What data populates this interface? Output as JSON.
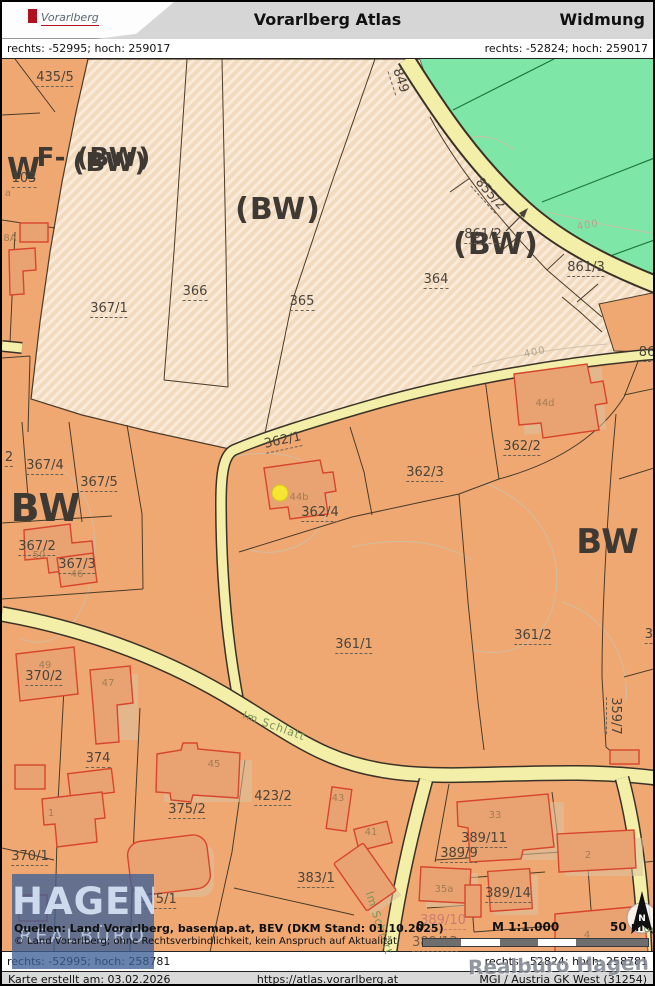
{
  "header": {
    "title": "Vorarlberg Atlas",
    "mode": "Widmung",
    "logo_text": "Vorarlberg"
  },
  "coords": {
    "top_left": "rechts: -52995; hoch: 259017",
    "top_right": "rechts: -52824; hoch: 259017",
    "bottom_left": "rechts: -52995; hoch: 258781",
    "bottom_right": "rechts: -52824; hoch: 258781"
  },
  "footer": {
    "created": "Karte erstellt am: 03.02.2026",
    "url": "https://atlas.vorarlberg.at",
    "crs": "MGI / Austria GK West (31254)"
  },
  "sources": {
    "line1": "Quellen: Land Vorarlberg, basemap.at, BEV (DKM Stand: 01.10.2025)",
    "line2": "© Land Vorarlberg; ohne Rechtsverbindlichkeit, kein Anspruch auf Aktualität"
  },
  "watermark": {
    "name": "HAGEN",
    "sub": "REALBÜRO",
    "corner": "Realbüro Hagen"
  },
  "scalebar": {
    "zero": "0",
    "scale": "M 1:1.000",
    "distance": "50 m"
  },
  "north": {
    "label": "N"
  },
  "colors": {
    "zone_bw": "#F0A873",
    "zone_planned": "#F2DABE",
    "zone_green": "#7EE6A7",
    "road": "#F3EFA8",
    "building_stroke": "#D7452C",
    "selection_dot": "#F6E632",
    "watermark_blue": "#3E6096"
  },
  "map": {
    "zone_labels": [
      {
        "t": "W",
        "x": 22,
        "y": 168,
        "s": 30
      },
      {
        "t": "F- (BW)",
        "x": 92,
        "y": 156,
        "s": 26
      },
      {
        "t": "(BW)",
        "x": 108,
        "y": 161,
        "s": 26
      },
      {
        "t": "(BW)",
        "x": 276,
        "y": 208,
        "s": 30
      },
      {
        "t": "(BW)",
        "x": 494,
        "y": 243,
        "s": 30
      },
      {
        "t": "BW",
        "x": 44,
        "y": 506,
        "s": 38
      },
      {
        "t": "BW",
        "x": 606,
        "y": 540,
        "s": 34
      }
    ],
    "parcel_labels": [
      {
        "t": "435/5",
        "x": 53,
        "y": 77
      },
      {
        "t": "103",
        "x": 22,
        "y": 178
      },
      {
        "t": "2",
        "x": 7,
        "y": 457
      },
      {
        "t": "367/1",
        "x": 107,
        "y": 308
      },
      {
        "t": "366",
        "x": 193,
        "y": 291
      },
      {
        "t": "365",
        "x": 300,
        "y": 301
      },
      {
        "t": "364",
        "x": 434,
        "y": 279
      },
      {
        "t": "849",
        "x": 397,
        "y": 79,
        "r": 72
      },
      {
        "t": "855/2",
        "x": 487,
        "y": 193,
        "r": 48
      },
      {
        "t": "861/2",
        "x": 481,
        "y": 234
      },
      {
        "t": "861/3",
        "x": 584,
        "y": 267
      },
      {
        "t": "86",
        "x": 645,
        "y": 352
      },
      {
        "t": "367/4",
        "x": 43,
        "y": 465
      },
      {
        "t": "367/5",
        "x": 97,
        "y": 482
      },
      {
        "t": "367/2",
        "x": 35,
        "y": 546
      },
      {
        "t": "367/3",
        "x": 75,
        "y": 564
      },
      {
        "t": "362/1",
        "x": 281,
        "y": 440,
        "r": -12
      },
      {
        "t": "362/2",
        "x": 520,
        "y": 446
      },
      {
        "t": "362/3",
        "x": 423,
        "y": 472
      },
      {
        "t": "362/4",
        "x": 318,
        "y": 512
      },
      {
        "t": "361/1",
        "x": 352,
        "y": 644
      },
      {
        "t": "361/2",
        "x": 531,
        "y": 635
      },
      {
        "t": "359/7",
        "x": 612,
        "y": 714,
        "r": 90
      },
      {
        "t": "35",
        "x": 651,
        "y": 634
      },
      {
        "t": "370/2",
        "x": 42,
        "y": 676
      },
      {
        "t": "374",
        "x": 96,
        "y": 758
      },
      {
        "t": "370/1",
        "x": 28,
        "y": 856
      },
      {
        "t": "375/2",
        "x": 185,
        "y": 809
      },
      {
        "t": "375/1",
        "x": 156,
        "y": 899
      },
      {
        "t": "423/2",
        "x": 271,
        "y": 796
      },
      {
        "t": "383/1",
        "x": 314,
        "y": 878
      },
      {
        "t": "389/11",
        "x": 482,
        "y": 838
      },
      {
        "t": "389/9",
        "x": 457,
        "y": 853
      },
      {
        "t": "389/14",
        "x": 506,
        "y": 893
      },
      {
        "t": "389/10",
        "x": 441,
        "y": 920,
        "c": "pink"
      },
      {
        "t": "389/12",
        "x": 433,
        "y": 942,
        "c": "dim"
      }
    ],
    "address_labels": [
      {
        "t": "a",
        "x": 6,
        "y": 192
      },
      {
        "t": "8A",
        "x": 8,
        "y": 237
      },
      {
        "t": "44d",
        "x": 543,
        "y": 402
      },
      {
        "t": "44b",
        "x": 297,
        "y": 496
      },
      {
        "t": "50",
        "x": 37,
        "y": 554
      },
      {
        "t": "46",
        "x": 75,
        "y": 573
      },
      {
        "t": "49",
        "x": 43,
        "y": 664
      },
      {
        "t": "47",
        "x": 106,
        "y": 682
      },
      {
        "t": "1",
        "x": 49,
        "y": 812
      },
      {
        "t": "45",
        "x": 212,
        "y": 763
      },
      {
        "t": "43",
        "x": 336,
        "y": 797
      },
      {
        "t": "41",
        "x": 369,
        "y": 831
      },
      {
        "t": "35a",
        "x": 442,
        "y": 888
      },
      {
        "t": "33",
        "x": 493,
        "y": 814
      },
      {
        "t": "2",
        "x": 586,
        "y": 854
      },
      {
        "t": "4",
        "x": 585,
        "y": 934
      }
    ],
    "street_labels": [
      {
        "t": "Im Schlatt",
        "x": 272,
        "y": 724,
        "r": 20
      },
      {
        "t": "Im Schlatt",
        "x": 377,
        "y": 921,
        "r": 72
      },
      {
        "t": "3",
        "x": 646,
        "y": 928,
        "r": 80
      }
    ],
    "contour_labels": [
      {
        "t": "400",
        "x": 586,
        "y": 224,
        "r": -10
      },
      {
        "t": "400",
        "x": 533,
        "y": 351,
        "r": -12
      }
    ]
  }
}
